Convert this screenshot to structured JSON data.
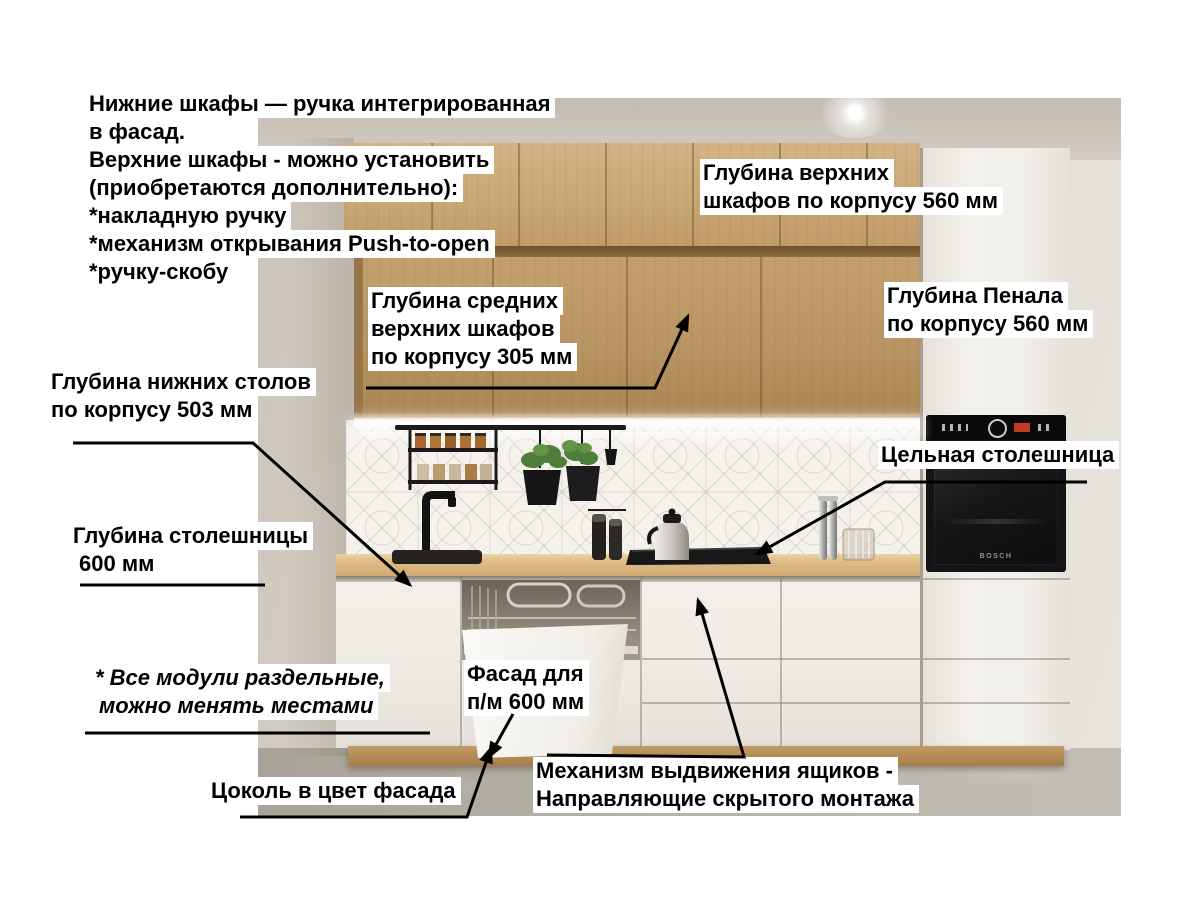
{
  "page": {
    "background": "#ffffff"
  },
  "annotations": {
    "handles_note": {
      "lines": [
        "Нижние шкафы — ручка интегрированная",
        "в фасад.",
        "Верхние шкафы - можно установить",
        "(приобретаются дополнительно):",
        "*накладную ручку",
        "*механизм открывания Push-to-open",
        "*ручку-скобу"
      ]
    },
    "upper_cabinet_depth": {
      "lines": [
        "Глубина верхних",
        "шкафов по корпусу 560 мм"
      ]
    },
    "mid_upper_cabinet_depth": {
      "lines": [
        "Глубина средних",
        "верхних шкафов",
        "по корпусу 305 мм"
      ]
    },
    "tall_unit_depth": {
      "lines": [
        "Глубина Пенала",
        "по корпусу 560 мм"
      ]
    },
    "base_cabinet_depth": {
      "lines": [
        "Глубина нижних столов",
        "по корпусу 503 мм"
      ]
    },
    "solid_countertop": {
      "lines": [
        "Цельная столешница"
      ]
    },
    "countertop_depth": {
      "lines": [
        "Глубина столешницы",
        "600 мм"
      ]
    },
    "modules_note": {
      "lines": [
        "* Все модули раздельные,",
        "можно менять местами"
      ]
    },
    "dishwasher_front": {
      "lines": [
        "Фасад для",
        "п/м 600 мм"
      ]
    },
    "plinth_note": {
      "lines": [
        "Цоколь в цвет фасада"
      ]
    },
    "drawer_mechanism": {
      "lines": [
        "Механизм выдвижения ящиков -",
        "Направляющие скрытого монтажа"
      ]
    }
  },
  "scene": {
    "oven_brand": "BOSCH"
  },
  "colors": {
    "annotation_text": "#000000",
    "annotation_bg": "#ffffff",
    "arrow": "#000000",
    "wood_cabinet": "#c9a672",
    "countertop": "#d9b787",
    "cabinet_white": "#efece6",
    "oven_black": "#141414",
    "floor": "#b4afa4",
    "plinth_wood": "#b68e57"
  }
}
